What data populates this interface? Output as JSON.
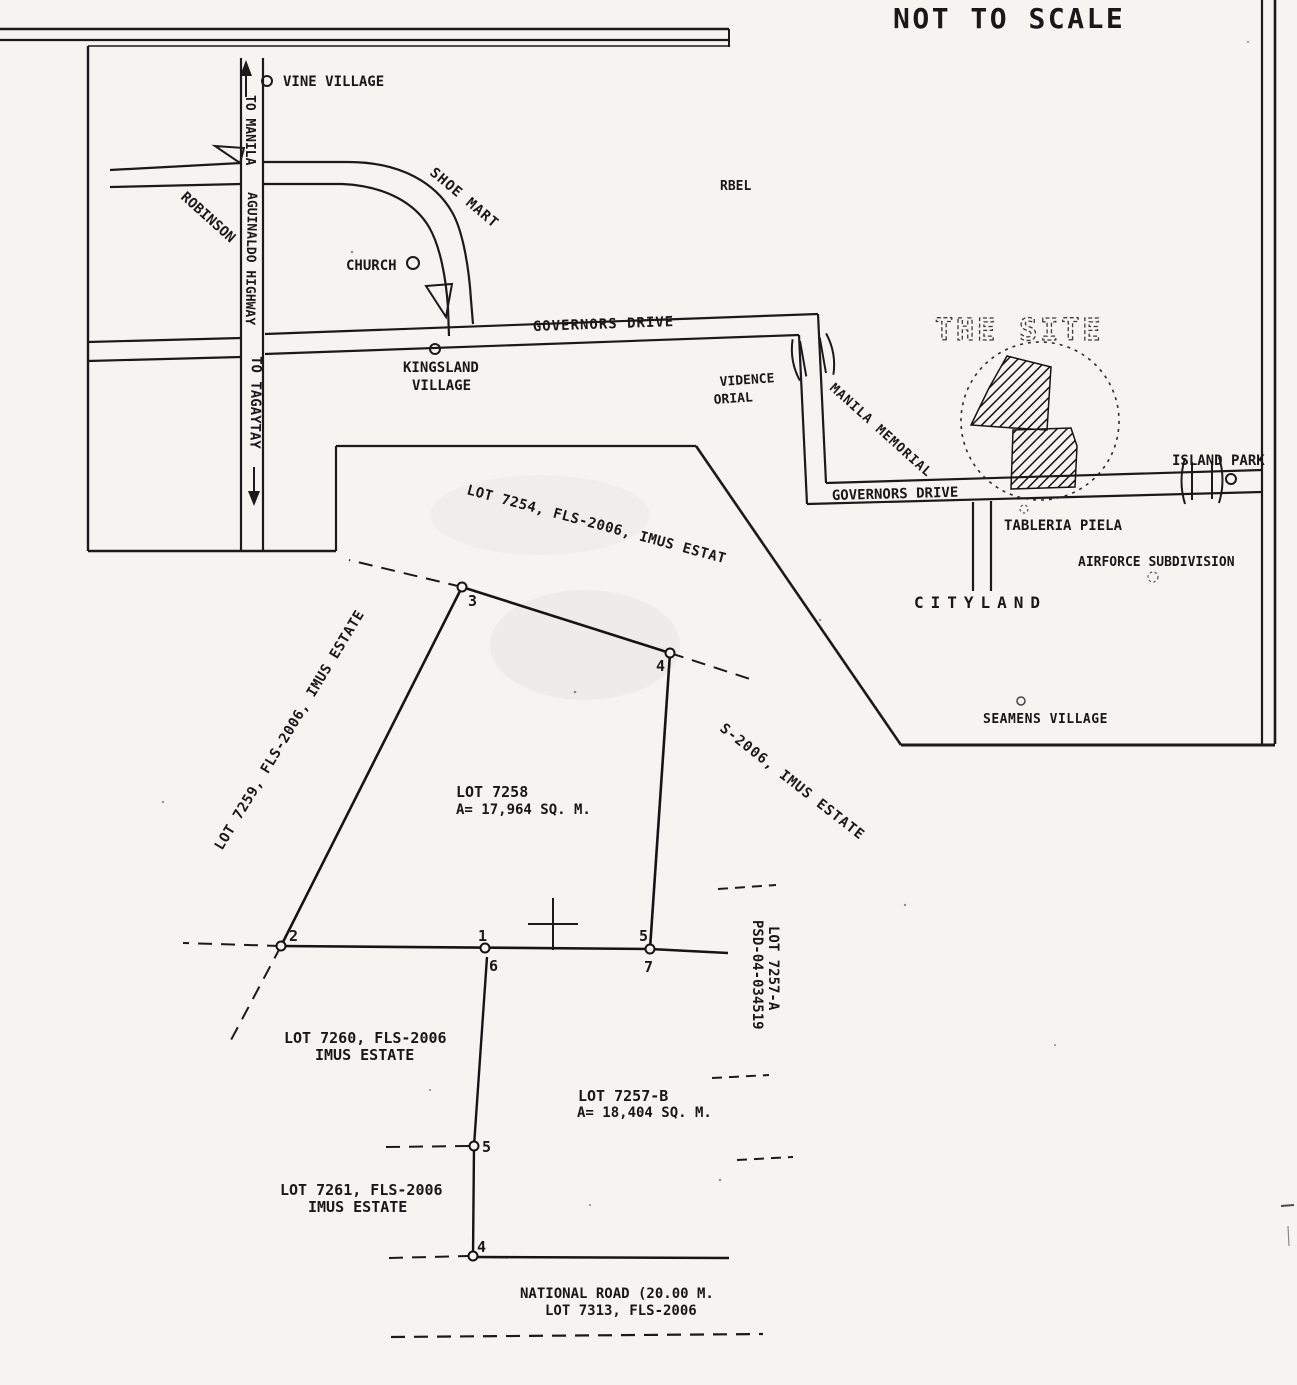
{
  "page": {
    "note": "NOT TO SCALE",
    "colors": {
      "paper": "#f5f4f1",
      "ink": "#1a1a1a",
      "faded_site_outline": "#3b3b3b"
    }
  },
  "vicinity_map": {
    "roads": {
      "to_manila": "TO MANILA",
      "aguinaldo_highway": "AGUINALDO HIGHWAY",
      "to_tagaytay": "TO TAGAYTAY",
      "governors_drive_upper": "GOVERNORS DRIVE",
      "governors_drive_lower": "GOVERNORS DRIVE"
    },
    "landmarks": {
      "vine_village": "VINE VILLAGE",
      "robinson": "ROBINSON",
      "shoe_mart": "SHOE MART",
      "church": "CHURCH",
      "kingsland_line1": "KINGSLAND",
      "kingsland_line2": "VILLAGE",
      "rbel": "RBEL",
      "providence_line1": "VIDENCE",
      "providence_line2": "ORIAL",
      "manila_memorial": "MANILA MEMORIAL",
      "the_site": "THE SITE",
      "island_park": "ISLAND PARK",
      "tableria_piela": "TABLERIA PIELA",
      "airforce_subdivision": "AIRFORCE SUBDIVISION",
      "cityland": "CITYLAND",
      "seamens_village": "SEAMENS VILLAGE"
    }
  },
  "sketch": {
    "lots": {
      "lot_7254": "LOT 7254, FLS-2006, IMUS ESTAT",
      "lot_7259": "LOT 7259, FLS-2006, IMUS ESTATE",
      "lot_7258_line1": "LOT 7258",
      "lot_7258_line2": "A= 17,964 SQ. M.",
      "lot_7255_partial": "S-2006, IMUS ESTATE",
      "lot_7260_line1": "LOT 7260, FLS-2006",
      "lot_7260_line2": "IMUS ESTATE",
      "lot_7257b_line1": "LOT 7257-B",
      "lot_7257b_line2": "A= 18,404 SQ. M.",
      "lot_7261_line1": "LOT 7261, FLS-2006",
      "lot_7261_line2": "IMUS ESTATE",
      "lot_7257a_line1": "LOT 7257-A",
      "lot_7257a_line2": "PSD-04-034519",
      "national_road_line1": "NATIONAL ROAD (20.00 M.",
      "national_road_line2": "LOT 7313, FLS-2006"
    },
    "points": {
      "p3": "3",
      "p4": "4",
      "p2": "2",
      "p1": "1",
      "p6": "6",
      "p5": "5",
      "p7": "7",
      "p5b": "5",
      "p4b": "4"
    }
  }
}
